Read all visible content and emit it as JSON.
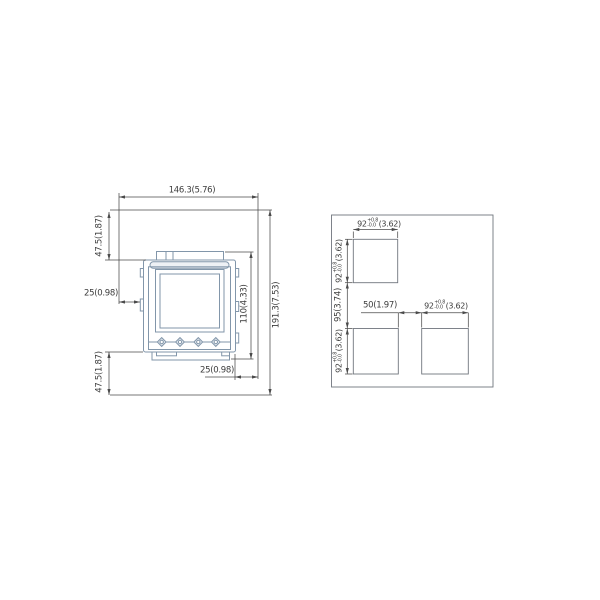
{
  "drawing": {
    "type": "technical-dimension-drawing",
    "views": [
      "device-front-external-dimensions",
      "panel-cutout-layout"
    ]
  },
  "colors": {
    "background": "#ffffff",
    "device_line": "#8296aa",
    "device_fill": "#ffffff",
    "bar_fill": "#eef1f5",
    "knob_fill": "#e8edf2",
    "cutout_line": "#70767e",
    "dimension_line": "#4a4a4a",
    "text": "#3c3c3c"
  },
  "left_view": {
    "labels": {
      "overall_width": "146.3(5.76)",
      "overall_height": "191.3(7.53)",
      "top_offset": "47.5(1.87)",
      "bottom_offset": "47.5(1.87)",
      "left_offset": "25(0.98)",
      "right_offset": "25(0.98)",
      "body_height": "110(4.33)"
    }
  },
  "right_view": {
    "labels": {
      "cutout_value": "92",
      "tol_plus": "+0.8",
      "tol_minus": "-0.0",
      "cutout_inch": "(3.62)",
      "vertical_spacing": "95(3.74)",
      "horizontal_spacing": "50(1.97)"
    }
  }
}
